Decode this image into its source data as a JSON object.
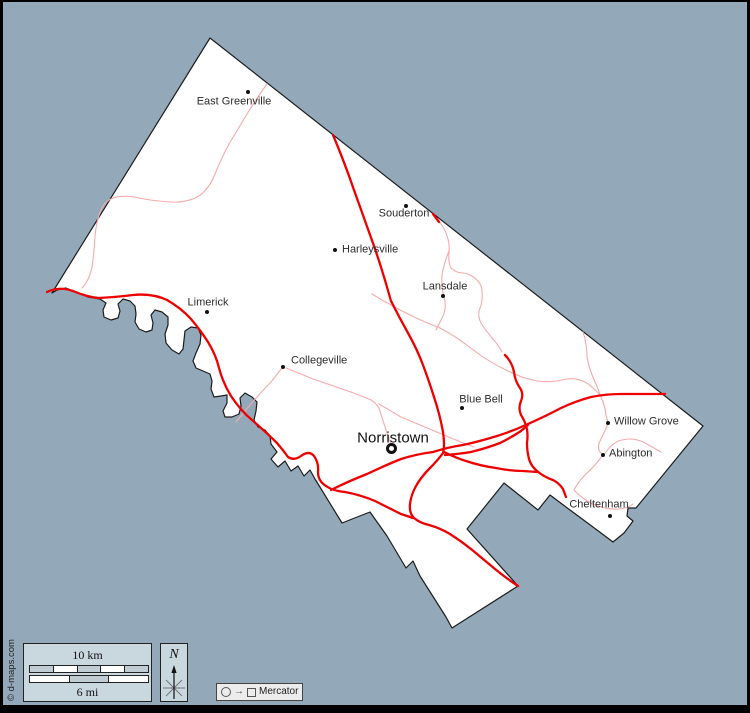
{
  "map": {
    "cities": [
      {
        "name": "East Greenville"
      },
      {
        "name": "Souderton"
      },
      {
        "name": "Harleysville"
      },
      {
        "name": "Lansdale"
      },
      {
        "name": "Limerick"
      },
      {
        "name": "Collegeville"
      },
      {
        "name": "Blue Bell"
      },
      {
        "name": "Norristown"
      },
      {
        "name": "Willow Grove"
      },
      {
        "name": "Abington"
      },
      {
        "name": "Cheltenham"
      }
    ]
  },
  "legend": {
    "scale_km": "10 km",
    "scale_mi": "6 mi",
    "compass": "N",
    "projection": "Mercator",
    "projection_arrow": "→"
  },
  "watermark": "© d-maps.com",
  "colors": {
    "sea": "#93a9ba",
    "land": "#ffffff",
    "boundary": "#1c1c1c",
    "road_major": "#ee0000",
    "road_minor": "#f6aaaa",
    "frame": "#000000",
    "panel": "#c9d7df",
    "legend_box": "#ececec"
  }
}
